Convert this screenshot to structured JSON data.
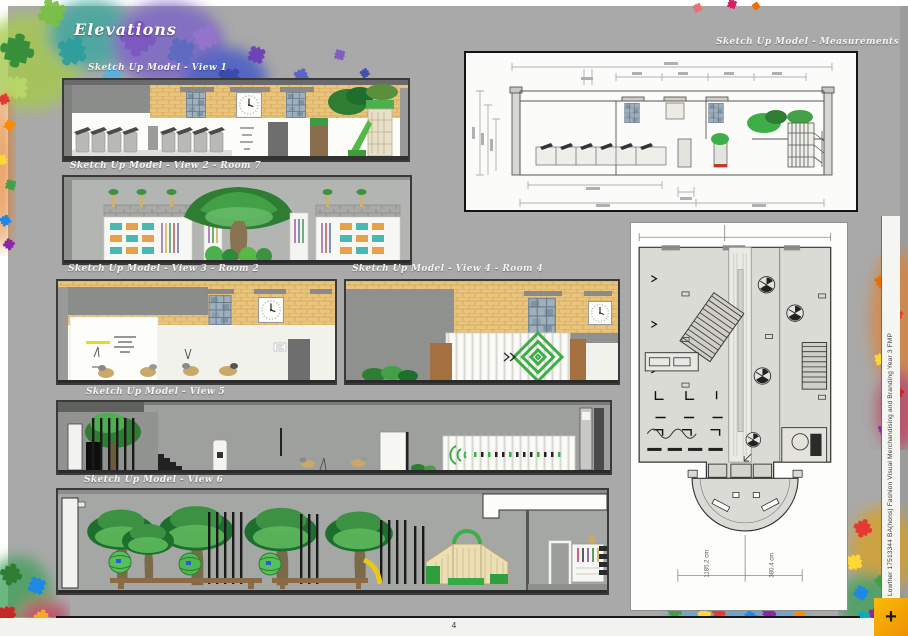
{
  "page": {
    "title": "Elevations",
    "page_number": "4",
    "side_text": "e Lowther 17513344   BA(hons) Fashion Visual Merchandising and Branding Year 3 FMP",
    "corner_button": "+"
  },
  "sections": [
    {
      "id": "view1",
      "label": "Sketch Up Model - View 1"
    },
    {
      "id": "view2",
      "label": "Sketch Up Model - View 2 - Room 7"
    },
    {
      "id": "view3",
      "label": "Sketch Up Model - View 3 - Room 2"
    },
    {
      "id": "view4",
      "label": "Sketch Up Model - View 4 - Room 4"
    },
    {
      "id": "view5",
      "label": "Sketch Up Model - View 5"
    },
    {
      "id": "view6",
      "label": "Sketch Up Model - View 6"
    },
    {
      "id": "measurements",
      "label": "Sketch Up Model - Measurements"
    }
  ],
  "plan": {
    "dimensions": [
      "1185.2 cm",
      "380.4 cm"
    ]
  },
  "colors": {
    "page_gray": "#a9a9a9",
    "wall_tan": "#e8c47c",
    "accent_green": "#3fae49",
    "accent_yellow": "#f2a705",
    "panel_border": "#3a3a3a"
  }
}
